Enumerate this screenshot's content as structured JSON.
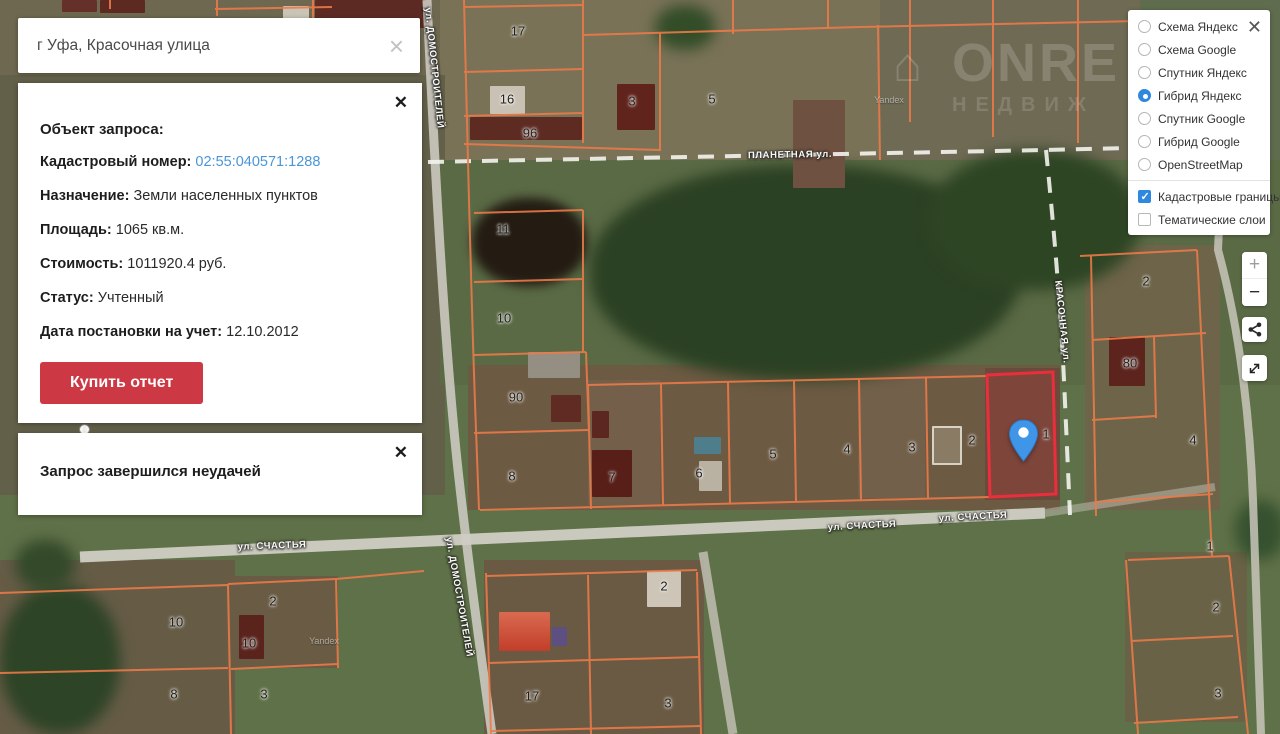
{
  "colors": {
    "boundary": "#ee7b49",
    "selected_red": "#ea2e3c",
    "accent_blue": "#2f88e0",
    "link": "#4b96d6",
    "button_red": "#cd3845",
    "pin_blue": "#3f96e8",
    "road_gray": "#cfccc3"
  },
  "icons": {
    "checkbox_check": "✓",
    "search_clear": "×",
    "panel_close": "✕"
  },
  "search": {
    "value": "г Уфа, Красочная улица",
    "clear_icon": "×"
  },
  "info_panel": {
    "close_icon": "✕",
    "title": "Объект запроса:",
    "rows": [
      {
        "label": "Кадастровый номер:",
        "value": "02:55:040571:1288",
        "link": true
      },
      {
        "label": "Назначение:",
        "value": "Земли населенных пунктов"
      },
      {
        "label": "Площадь:",
        "value": "1065 кв.м."
      },
      {
        "label": "Стоимость:",
        "value": "1011920.4 руб."
      },
      {
        "label": "Статус:",
        "value": "Учтенный"
      },
      {
        "label": "Дата постановки на учет:",
        "value": "12.10.2012"
      }
    ],
    "buy_button": "Купить отчет"
  },
  "error_panel": {
    "close_icon": "✕",
    "message": "Запрос завершился неудачей"
  },
  "layers_panel": {
    "close_icon": "✕",
    "base_layers": [
      {
        "label": "Схема Яндекс",
        "selected": false
      },
      {
        "label": "Схема Google",
        "selected": false
      },
      {
        "label": "Спутник Яндекс",
        "selected": false
      },
      {
        "label": "Гибрид Яндекс",
        "selected": true
      },
      {
        "label": "Спутник Google",
        "selected": false
      },
      {
        "label": "Гибрид Google",
        "selected": false
      },
      {
        "label": "OpenStreetMap",
        "selected": false
      }
    ],
    "overlays": [
      {
        "label": "Кадастровые границы",
        "checked": true
      },
      {
        "label": "Тематические слои",
        "checked": false
      }
    ]
  },
  "map_controls": {
    "zoom_in_label": "+",
    "zoom_out_label": "−"
  },
  "map": {
    "selected_parcel_number": "1",
    "brand": {
      "glyph": "⌂",
      "line1": "ONRE",
      "line2": "НЕДВИЖ"
    },
    "watermarks": [
      {
        "text": "Yandex",
        "x": 889,
        "y": 100
      },
      {
        "text": "Yandex",
        "x": 324,
        "y": 641
      }
    ],
    "street_labels": [
      {
        "text": "ул. ДОМОСТРОИТЕЛЕЙ",
        "x": 434,
        "y": 68,
        "rot": 84
      },
      {
        "text": "ПЛАНЕТНАЯ ул.",
        "x": 790,
        "y": 155,
        "rot": -1
      },
      {
        "text": "КРАСОЧНАЯ ул.",
        "x": 1062,
        "y": 322,
        "rot": 84
      },
      {
        "text": "ул. СЧАСТЬЯ",
        "x": 272,
        "y": 546,
        "rot": -2
      },
      {
        "text": "ул. СЧАСТЬЯ",
        "x": 862,
        "y": 526,
        "rot": -3
      },
      {
        "text": "ул. СЧАСТЬЯ",
        "x": 973,
        "y": 517,
        "rot": -3
      },
      {
        "text": "ул. ДОМОСТРОИТЕЛЕЙ",
        "x": 459,
        "y": 597,
        "rot": 80
      }
    ],
    "parcel_labels": [
      {
        "text": "17",
        "x": 518,
        "y": 31
      },
      {
        "text": "16",
        "x": 507,
        "y": 99
      },
      {
        "text": "96",
        "x": 530,
        "y": 133
      },
      {
        "text": "3",
        "x": 632,
        "y": 101
      },
      {
        "text": "5",
        "x": 712,
        "y": 99
      },
      {
        "text": "11",
        "x": 503,
        "y": 229
      },
      {
        "text": "10",
        "x": 504,
        "y": 318
      },
      {
        "text": "90",
        "x": 516,
        "y": 397
      },
      {
        "text": "8",
        "x": 512,
        "y": 476
      },
      {
        "text": "7",
        "x": 612,
        "y": 477
      },
      {
        "text": "6",
        "x": 699,
        "y": 473
      },
      {
        "text": "5",
        "x": 773,
        "y": 454
      },
      {
        "text": "4",
        "x": 847,
        "y": 449
      },
      {
        "text": "3",
        "x": 912,
        "y": 447
      },
      {
        "text": "2",
        "x": 972,
        "y": 440
      },
      {
        "text": "1",
        "x": 1046,
        "y": 434
      },
      {
        "text": "2",
        "x": 1146,
        "y": 281
      },
      {
        "text": "80",
        "x": 1130,
        "y": 363
      },
      {
        "text": "4",
        "x": 1193,
        "y": 440
      },
      {
        "text": "1",
        "x": 1210,
        "y": 546
      },
      {
        "text": "2",
        "x": 1216,
        "y": 607
      },
      {
        "text": "3",
        "x": 1218,
        "y": 693
      },
      {
        "text": "2",
        "x": 664,
        "y": 586
      },
      {
        "text": "17",
        "x": 532,
        "y": 696
      },
      {
        "text": "3",
        "x": 668,
        "y": 703
      },
      {
        "text": "10",
        "x": 176,
        "y": 622
      },
      {
        "text": "2",
        "x": 273,
        "y": 601
      },
      {
        "text": "10",
        "x": 249,
        "y": 643
      },
      {
        "text": "8",
        "x": 174,
        "y": 694
      },
      {
        "text": "3",
        "x": 264,
        "y": 694
      }
    ]
  }
}
